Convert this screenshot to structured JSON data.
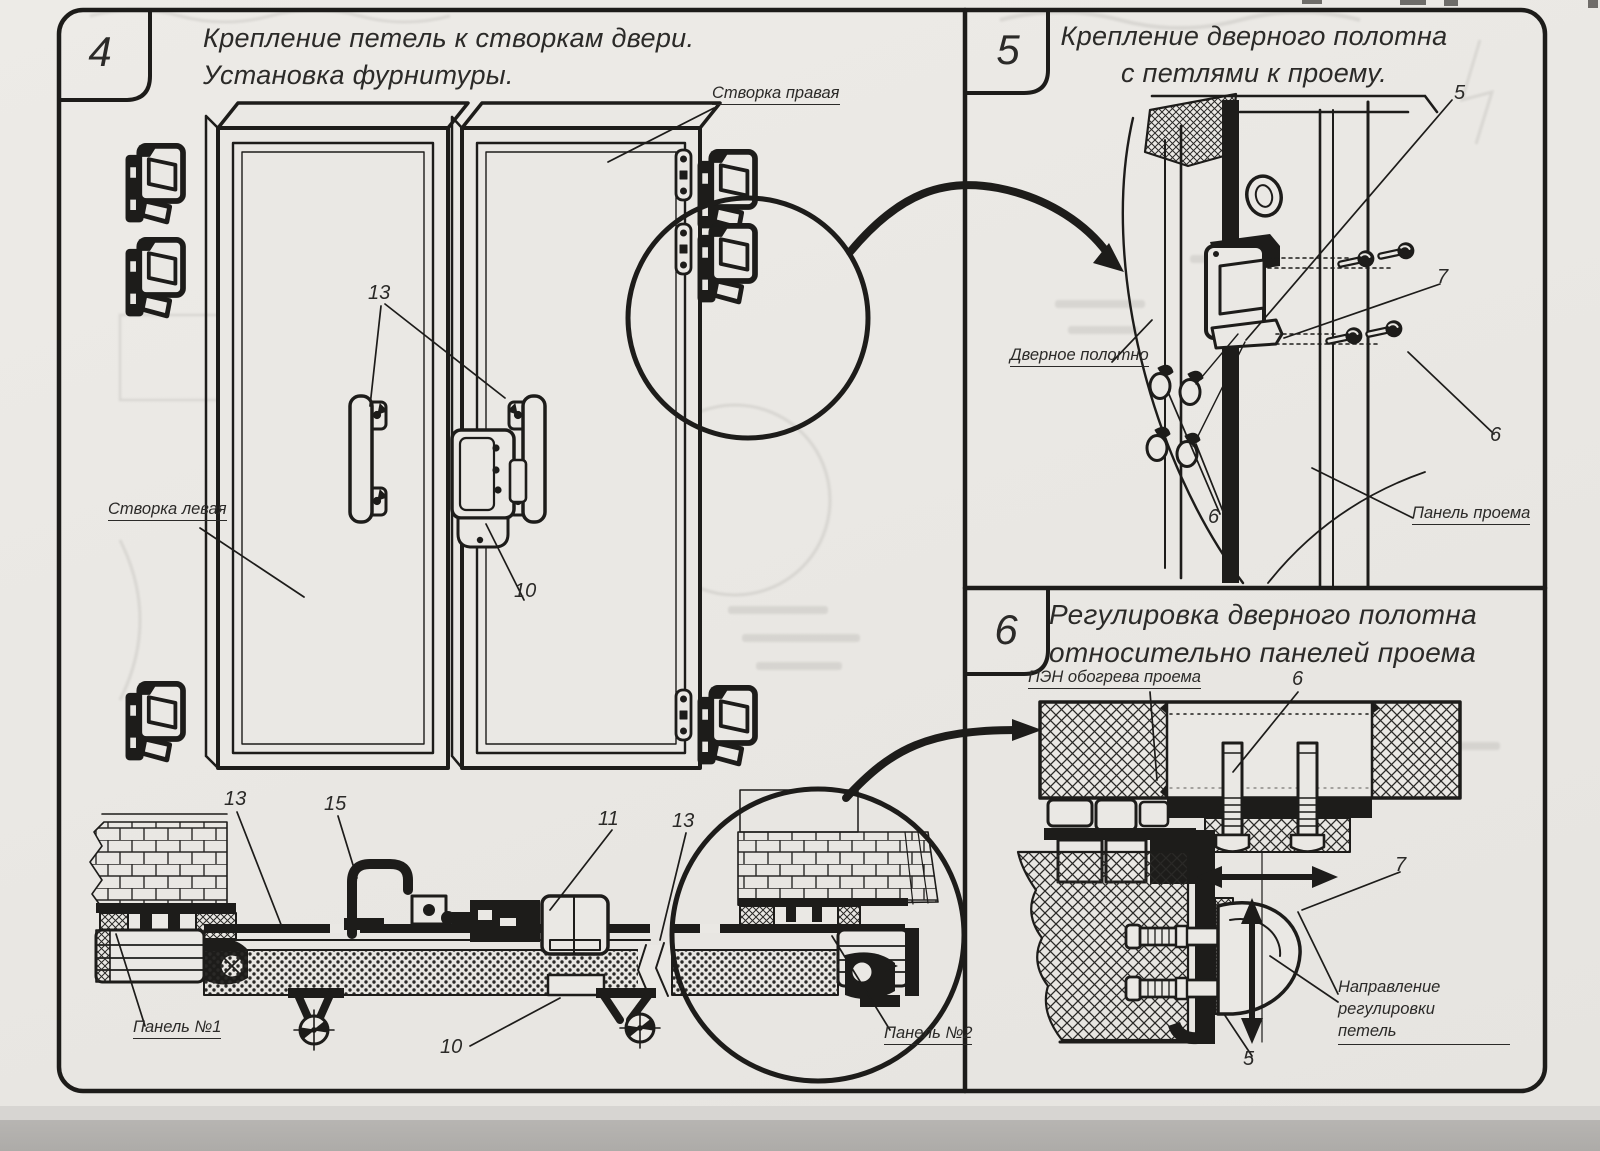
{
  "page": {
    "ink": "#1d1c1a",
    "paper": "#eae8e4",
    "scan_strip": "#b3b1ae"
  },
  "panel4": {
    "number": "4",
    "title_line1": "Крепление петель к створкам двери.",
    "title_line2": "Установка фурнитуры.",
    "labels": {
      "door_right": "Створка правая",
      "door_left": "Створка левая",
      "panel1": "Панель №1",
      "panel2": "Панель №2"
    },
    "callouts": {
      "handles": "13",
      "latch_top": "10",
      "sec_13": "13",
      "sec_15": "15",
      "sec_11": "11",
      "sec_13b": "13",
      "sec_10": "10"
    }
  },
  "panel5": {
    "number": "5",
    "title_line1": "Крепление дверного полотна",
    "title_line2": "с петлями к проему.",
    "labels": {
      "door_leaf": "Дверное полотно",
      "opening_panel": "Панель проема"
    },
    "callouts": {
      "c5": "5",
      "c7": "7",
      "c6_right": "6",
      "c6_bottom": "6"
    }
  },
  "panel6": {
    "number": "6",
    "title_line1": "Регулировка дверного полотна",
    "title_line2": "относительно панелей проема",
    "labels": {
      "pen": "ПЭН обогрева проема",
      "direction_line1": "Направление регулировки",
      "direction_line2": "петель"
    },
    "callouts": {
      "c6": "6",
      "c7": "7",
      "c5": "5"
    }
  }
}
